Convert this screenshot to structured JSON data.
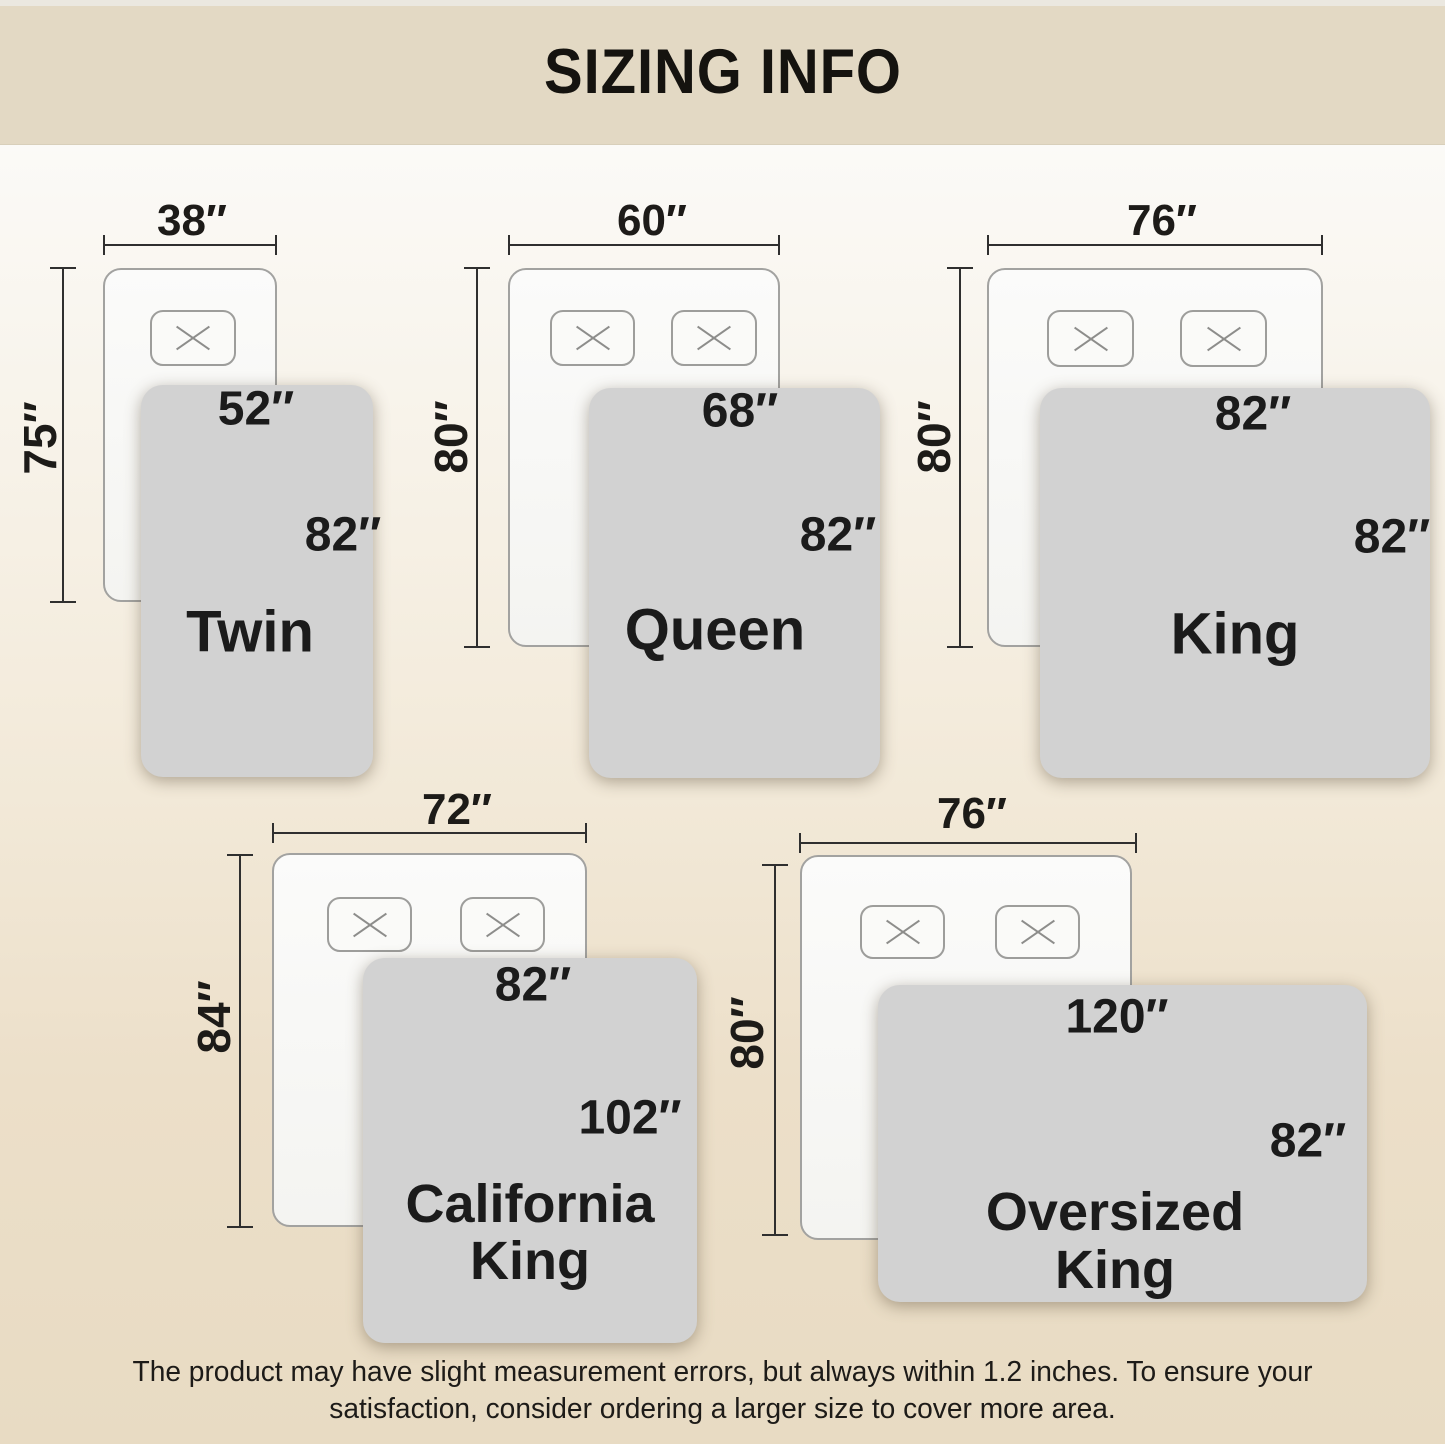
{
  "header": {
    "title": "SIZING INFO"
  },
  "footer": {
    "lines": [
      "The product may have slight measurement errors, but always within 1.2 inches. To ensure your",
      "satisfaction, consider ordering a larger size to cover more area."
    ]
  },
  "colors": {
    "header_bg": "#e3d9c4",
    "background_top": "#fbfaf7",
    "background_bottom": "#e8dbc3",
    "blanket_fill": "#d2d2d2",
    "mattress_fill": "#f8f8f6",
    "dimension_line": "#2f2f2f",
    "text": "#1b1b1b"
  },
  "sizes": [
    {
      "name": "Twin",
      "mattress_width": "38″",
      "mattress_length": "75″",
      "blanket_width": "52″",
      "blanket_length": "82″",
      "pillows": 1
    },
    {
      "name": "Queen",
      "mattress_width": "60″",
      "mattress_length": "80″",
      "blanket_width": "68″",
      "blanket_length": "82″",
      "pillows": 2
    },
    {
      "name": "King",
      "mattress_width": "76″",
      "mattress_length": "80″",
      "blanket_width": "82″",
      "blanket_length": "82″",
      "pillows": 2
    },
    {
      "name": "California King",
      "name_lines": [
        "California",
        "King"
      ],
      "mattress_width": "72″",
      "mattress_length": "84″",
      "blanket_width": "82″",
      "blanket_length": "102″",
      "pillows": 2
    },
    {
      "name": "Oversized King",
      "name_lines": [
        "Oversized",
        "King"
      ],
      "mattress_width": "76″",
      "mattress_length": "80″",
      "blanket_width": "120″",
      "blanket_length": "82″",
      "pillows": 2
    }
  ]
}
